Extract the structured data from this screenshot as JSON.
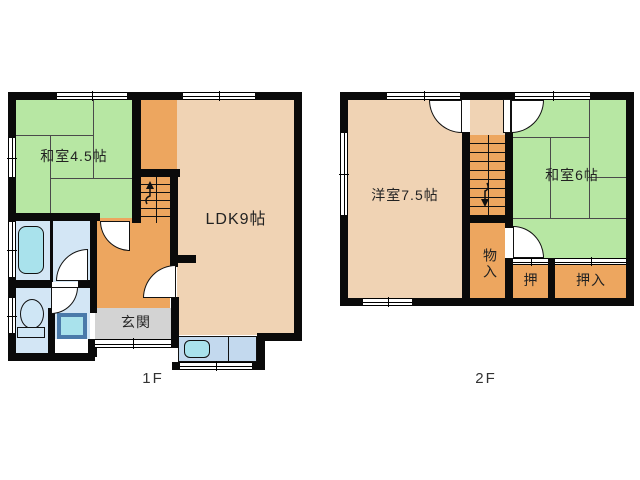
{
  "title": "2-story floor plan",
  "floors": {
    "f1": {
      "label": "1F",
      "rooms": {
        "washitsu45": "和室4.5帖",
        "ldk": "LDK9帖",
        "genkan": "玄関"
      }
    },
    "f2": {
      "label": "2F",
      "rooms": {
        "yoshitsu75": "洋室7.5帖",
        "washitsu6": "和室6帖",
        "monoire": "物入",
        "oshi": "押",
        "oshiire": "押入"
      }
    }
  },
  "icons": {
    "bathtub": "css-rounded-rect",
    "toilet": "css-ellipse-plus-base",
    "washbasin": "css-bordered-square",
    "kitchen_sink": "css-rounded-rect",
    "stairs_up_arrow": "svg-arrow-up",
    "stairs_down_arrow": "svg-arrow-down",
    "door_swing": "css-quarter-circle",
    "window": "css-double-line"
  },
  "colors": {
    "wall": "#0a0a0a",
    "tatami_green": "#b7e7a3",
    "room_peach": "#f0d3b4",
    "hall_orange": "#eda65f",
    "genkan_gray": "#d3d3d3",
    "wet_blue": "#d3e6f5",
    "fixture_cyan": "#a9e2ec",
    "counter_blue": "#c3d9ee",
    "washbasin_border": "#4a7aaa"
  }
}
